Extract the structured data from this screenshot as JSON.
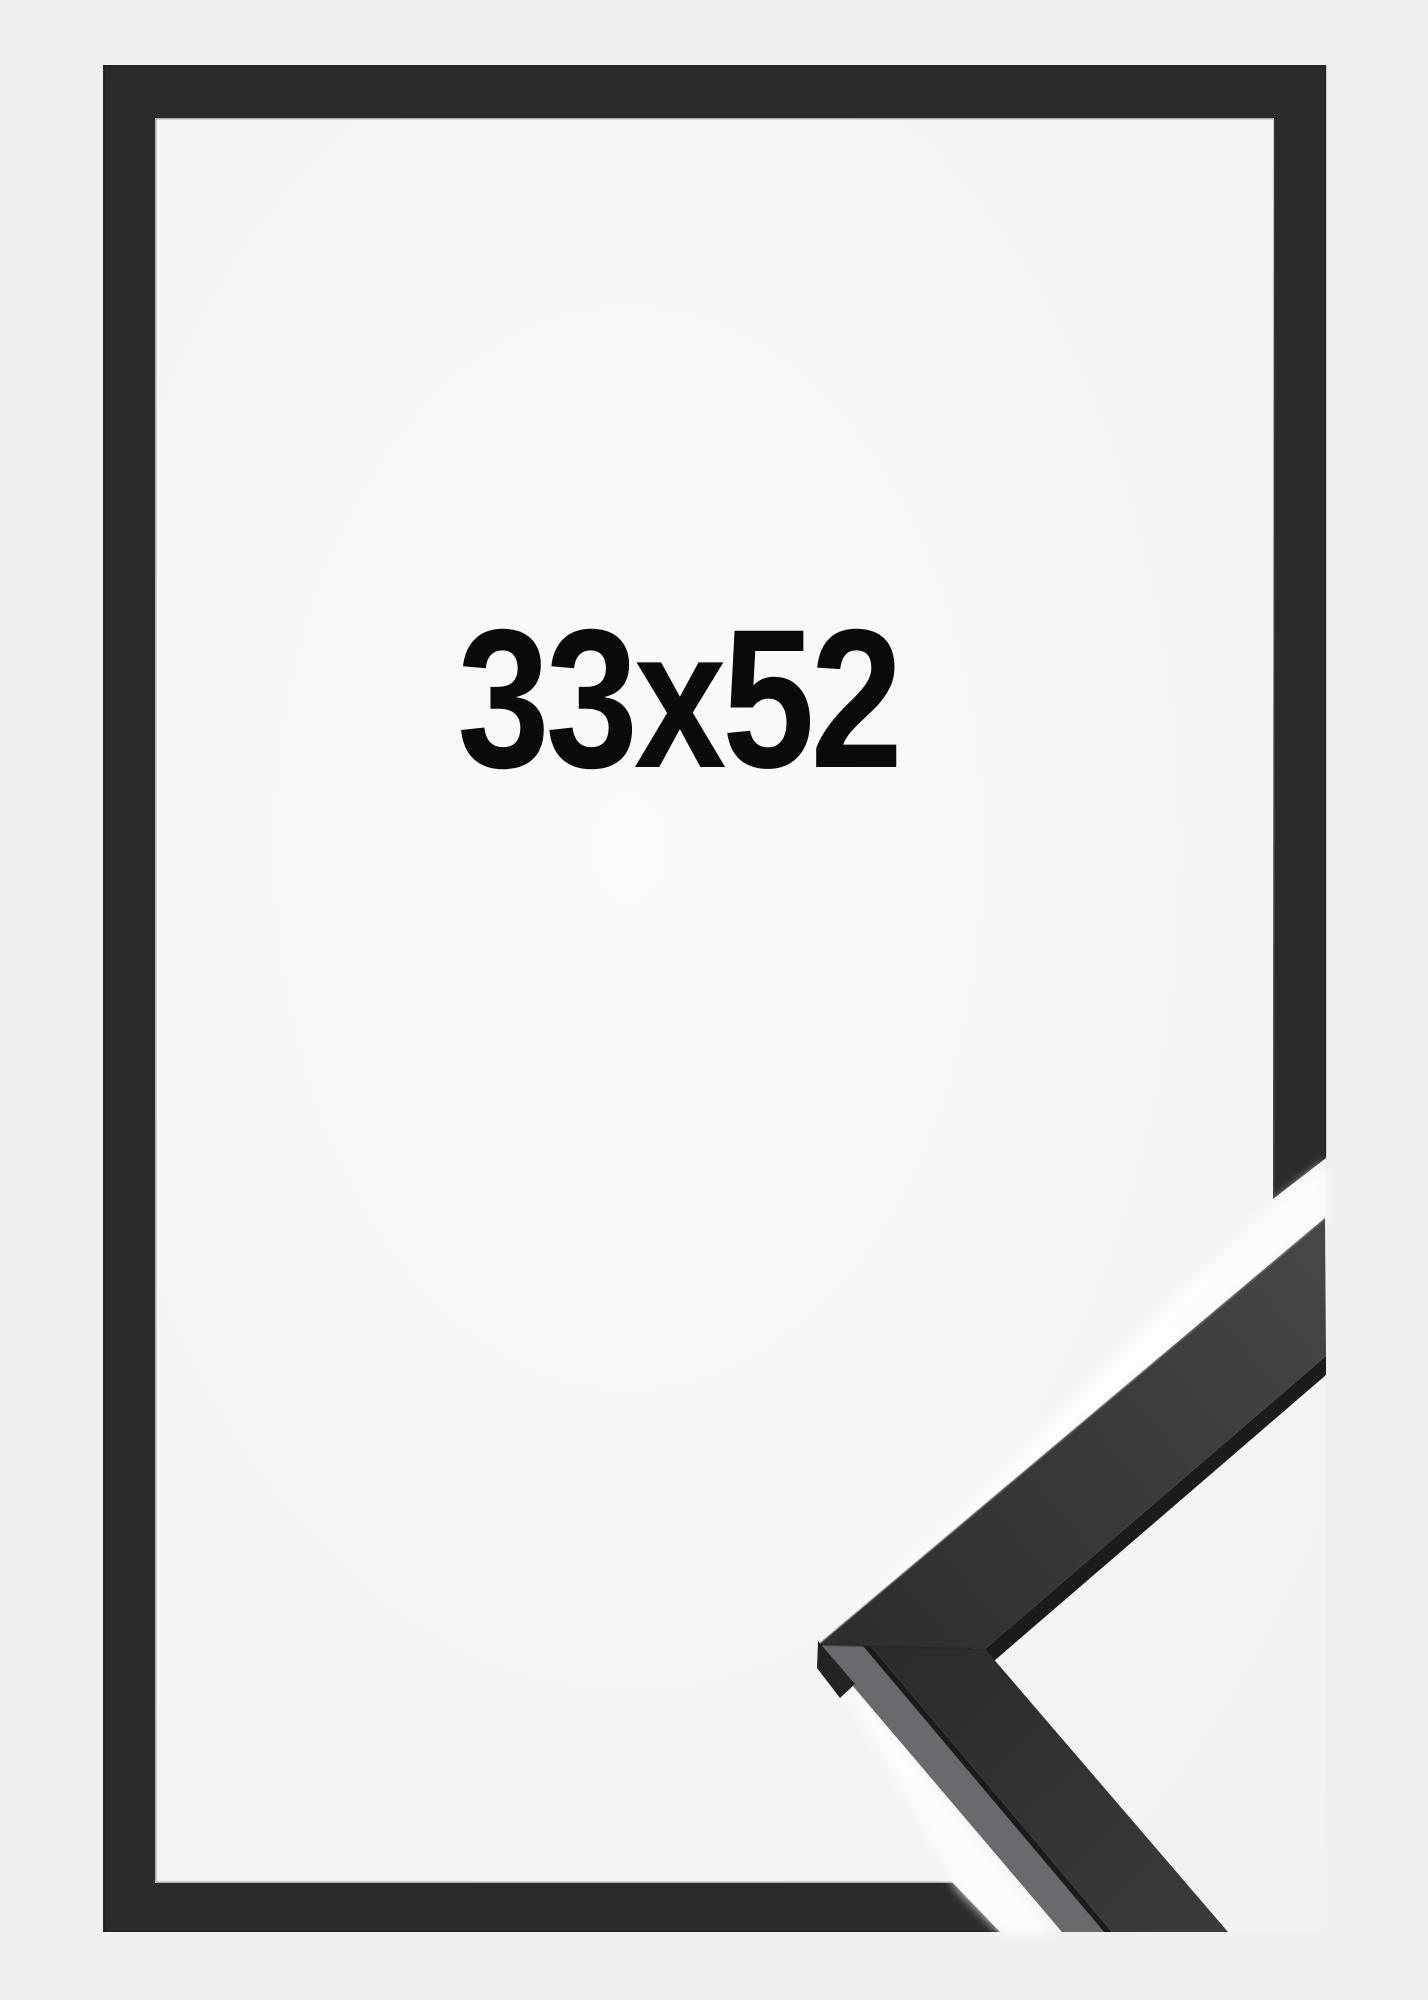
{
  "product_image": {
    "size_label": "33x52"
  },
  "colors": {
    "page_background": "#f0f0f1",
    "photo_center": "#fbfbfb",
    "photo_edge": "#f1f1f2",
    "frame": "#2b2b2d",
    "frame_outer_edge": "#1d1d1f",
    "frame_inner_highlight": "#5a5a5d",
    "miter_seam": "#1b1b1d",
    "halo": "#ffffff",
    "profile_face_dark": "#2e2e30",
    "profile_face_light": "#47474a",
    "profile_face_lower_dark": "#2b2b2d",
    "profile_face_lower_light": "#3a3a3d",
    "profile_bevel": "#6a6a6e",
    "profile_shadow_edge": "#1b1b1d",
    "profile_top_highlight": "#7d7d81",
    "apex_shadow": "#232325",
    "label_text": "#0a0a0a"
  }
}
